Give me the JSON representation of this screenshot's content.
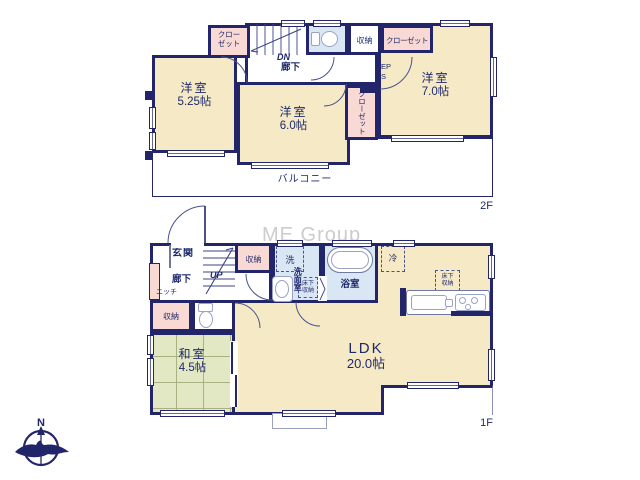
{
  "watermark": "ME Group",
  "compass": {
    "north": "N"
  },
  "colors": {
    "wall": "#23256b",
    "room_cream": "#f6e9c6",
    "closet_pink": "#f8d9d3",
    "wet_area_blue": "#d9e6f3",
    "tatami_green": "#e2e7c4",
    "text_navy": "#1e2a6b",
    "watermark_gray": "#c4c4c4"
  },
  "floor2": {
    "label": "2F",
    "room_525": {
      "name": "洋室",
      "size": "5.25帖"
    },
    "room_60": {
      "name": "洋室",
      "size": "6.0帖"
    },
    "room_70": {
      "name": "洋室",
      "size": "7.0帖"
    },
    "closet_top_left": "クローゼット",
    "closet_top_right": "クローゼット",
    "closet_center": "クローゼット",
    "storage": "収納",
    "stairs_dn": "DN",
    "hallway": "廊下",
    "eps": "EPS",
    "balcony": "バルコニー"
  },
  "floor1": {
    "label": "1F",
    "entrance": "玄関",
    "hallway": "廊下",
    "niche": "ニッチ",
    "stairs_up": "UP",
    "storage_hall": "収納",
    "storage_lower": "収納",
    "laundry": "洗",
    "washroom": "洗面室",
    "underfloor_storage_wash": "床下収納",
    "underfloor_storage_kitchen": "床下収納",
    "bathroom": "浴室",
    "refrigerator": "冷",
    "washitsu": {
      "name": "和室",
      "size": "4.5帖"
    },
    "ldk": {
      "name": "LDK",
      "size": "20.0帖"
    }
  }
}
